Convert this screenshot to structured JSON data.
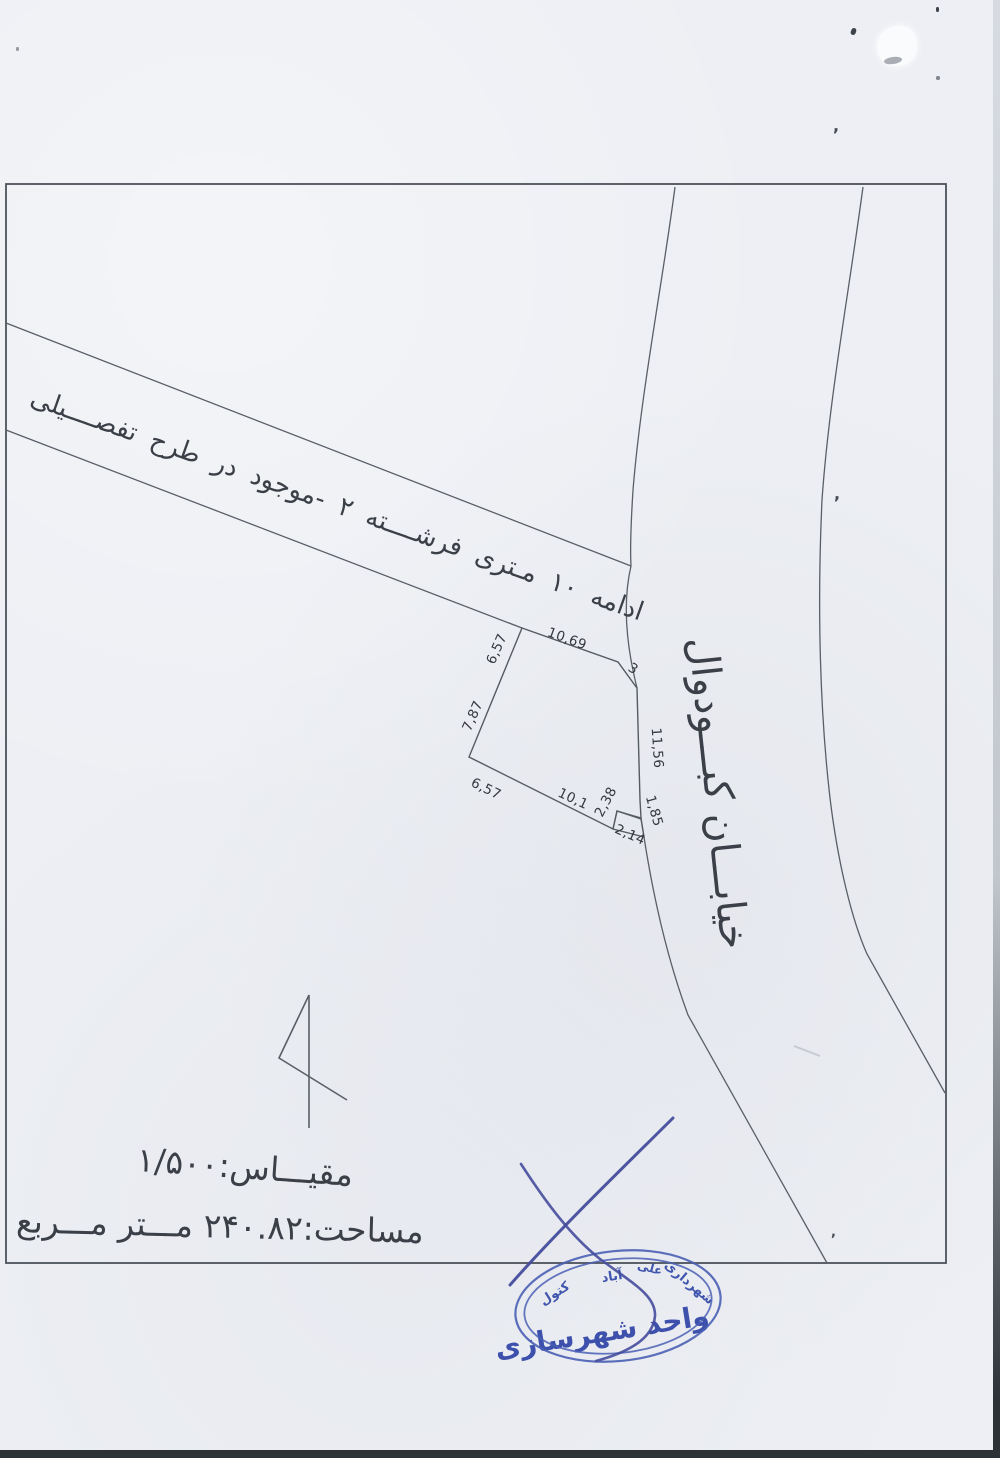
{
  "map": {
    "road_label": "ادامه ۱۰ مـتری فرشــــته ۲ -موجود در طرح تفصــــیلی",
    "street_label": "خیابـــان کبـــودوال",
    "dimensions": [
      "10,69",
      "3",
      "11,56",
      "1,85",
      "2,38",
      "2,14",
      "10,1",
      "6,57",
      "7,87",
      "6,57"
    ]
  },
  "notes": {
    "scale": "مقیـــاس:۱/۵۰۰",
    "area": "مساحت:۲۴۰.۸۲ مـــتر مـــربع"
  },
  "stamp": {
    "top_words": [
      "شهرداری",
      "علی",
      "آباد",
      "کتول"
    ],
    "unit": "واحد شهرسازی"
  },
  "icons": {
    "north_arrow": "north-arrow-icon"
  },
  "artifacts": {
    "comma": ","
  },
  "colors": {
    "paper": "#edeff4",
    "frame_line": "#4d525a",
    "map_line": "#5a5f67",
    "text": "#3b3f47",
    "ink_blue": "#454d9c",
    "stamp_blue": "#4a5fb4",
    "scan_border": "#2d3237"
  }
}
